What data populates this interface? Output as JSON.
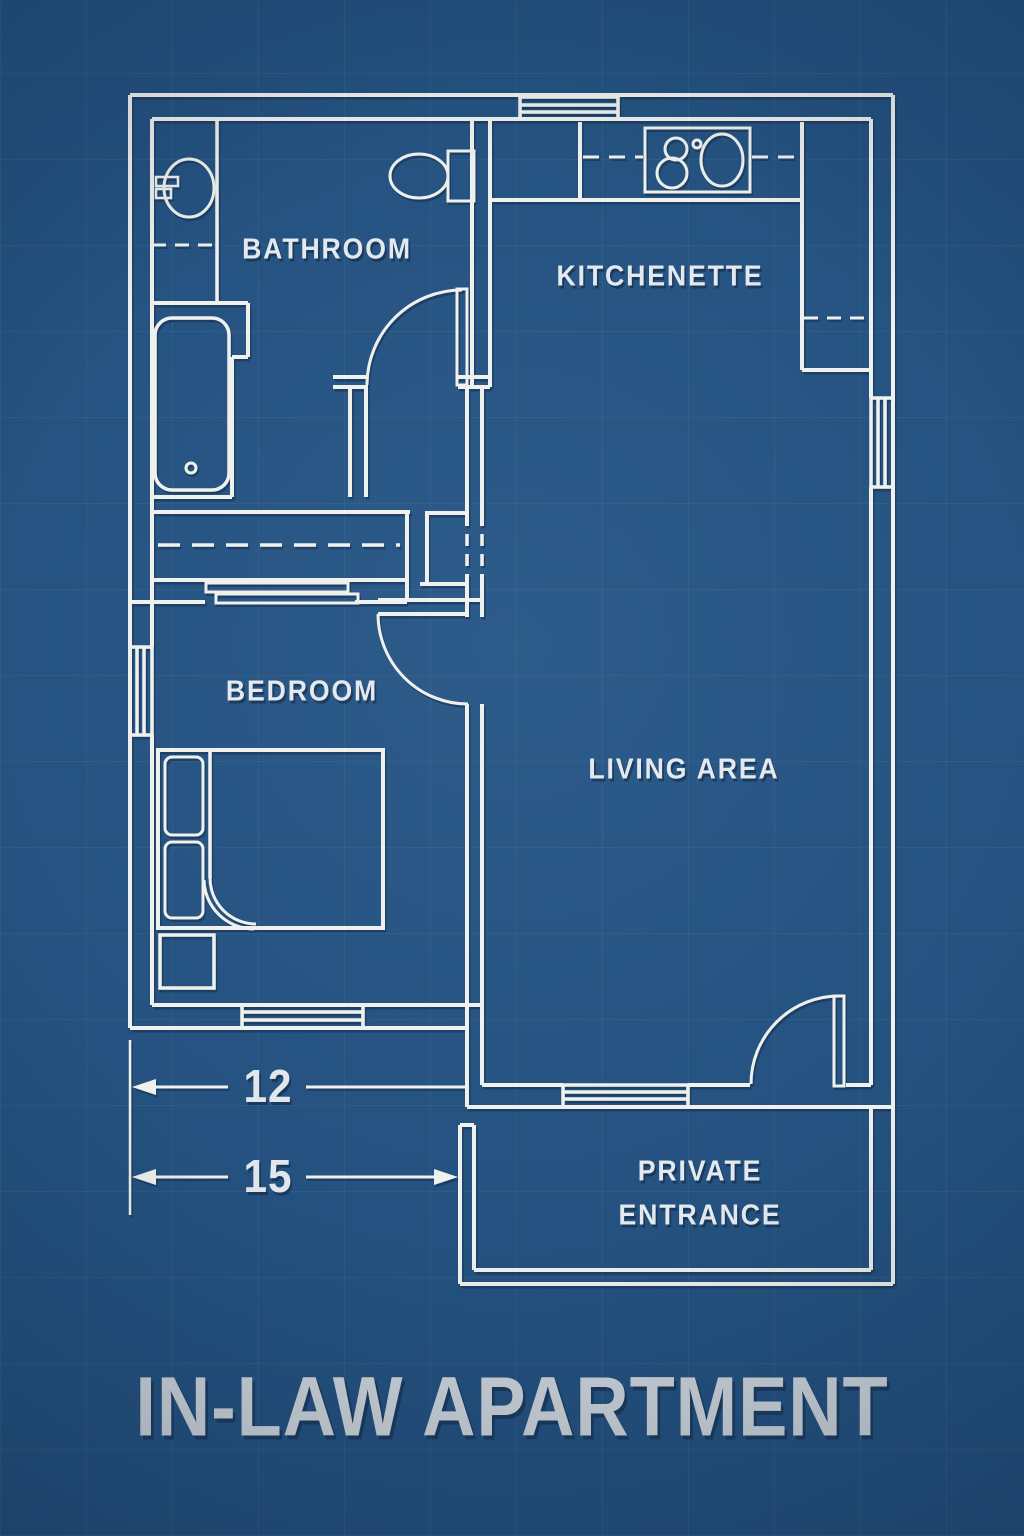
{
  "title": "IN-LAW APARTMENT",
  "labels": {
    "bathroom": "BATHROOM",
    "kitchenette": "KITCHENETTE",
    "bedroom": "BEDROOM",
    "living_area": "LIVING AREA",
    "private_entrance": "PRIVATE\nENTRANCE"
  },
  "dimensions": {
    "interior_width": "12",
    "overall_width": "15"
  },
  "rooms": [
    {
      "name": "Bathroom",
      "fixtures": [
        "vanity-sink",
        "toilet",
        "bathtub",
        "swing-door"
      ]
    },
    {
      "name": "Kitchenette",
      "fixtures": [
        "refrigerator-box",
        "sink-cooktop-unit",
        "counter",
        "upper-cabinets-dashed"
      ]
    },
    {
      "name": "Bedroom",
      "fixtures": [
        "bed",
        "pillows",
        "blanket-fold",
        "nightstand",
        "closet-with-rod",
        "sliding-bypass-doors",
        "swing-door"
      ]
    },
    {
      "name": "Living Area",
      "fixtures": [
        "entry-swing-door"
      ]
    },
    {
      "name": "Private Entrance",
      "fixtures": [
        "porch-outline"
      ]
    }
  ],
  "windows": [
    "top-wall-window",
    "right-wall-window",
    "left-wall-window",
    "bedroom-bottom-window",
    "living-bottom-window"
  ],
  "colors": {
    "background": "#24517f",
    "line": "#eef1ed",
    "label_text": "#e3e9ef",
    "title_text": "#ced4da",
    "shadow": "#0d2747"
  }
}
